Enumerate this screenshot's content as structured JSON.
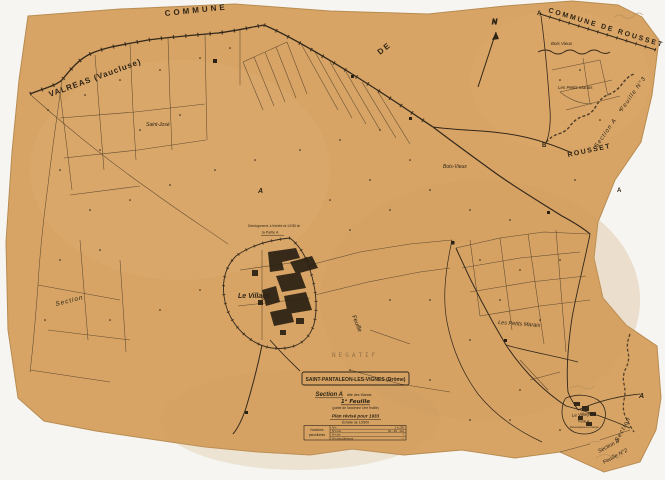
{
  "colors": {
    "paper": "#d7a466",
    "ink": "#2e2415",
    "stamp": "#8b7a5c",
    "background": "#f6f5f1"
  },
  "labels": {
    "commune": "COMMUNE",
    "de": "DE",
    "valreas": "VALREAS (Vaucluse)",
    "commune_rousset": "COMMUNE DE ROUSSET",
    "north": "N",
    "bois_vieux_ne": "Bois Vieux",
    "petits_marais_ne": "Les Petits Marais",
    "section_a_feuille_3": "Section A    Feuille N°3",
    "rousset": "ROUSSET",
    "saint_jose": "Saint-José",
    "bois_vieux": "Bois-Vieux",
    "petits_marais": "Les Petits Marais",
    "section_w": "Section",
    "feuille": "Feuille",
    "le_village": "Le Village",
    "inset_note_1": "Développement, à l'échelle de 1/1250 de",
    "inset_note_2": "la Partie A",
    "le_village_se": "Le Village",
    "partie_a_se": "Partie A",
    "developpee": "Développée en marge",
    "section_se": "Section",
    "section_b": "Section B",
    "feuille_2": "Feuille N°2",
    "marker_a_nw": "A",
    "marker_a_ne": "A",
    "marker_b": "B",
    "marker_a_e": "A",
    "marker_a_se": "A",
    "stamp": "NEGATIF"
  },
  "cartouche": {
    "title": "SAINT-PANTALEON-LES-VIGNES (Drôme)",
    "section": "Section A",
    "section_suffix": "dite des Marais",
    "feuille": "1ᵉ Feuille",
    "feuille_note": "(partie de l'ancienne 1ère feuille)",
    "plan": "Plan révisé pour 1933",
    "echelle": "Échelle de 1/2500",
    "table": {
      "header_1": "Nombres",
      "header_2": "parcellaires",
      "rows": [
        {
          "label": "N°s",
          "value": "1 à 205"
        },
        {
          "label": "N°s bis",
          "value": "62 - 93 - 141"
        },
        {
          "label": "N°s ter",
          "value": "7"
        },
        {
          "label": "N°s bis ultérieurs",
          "value": "—"
        }
      ]
    }
  }
}
